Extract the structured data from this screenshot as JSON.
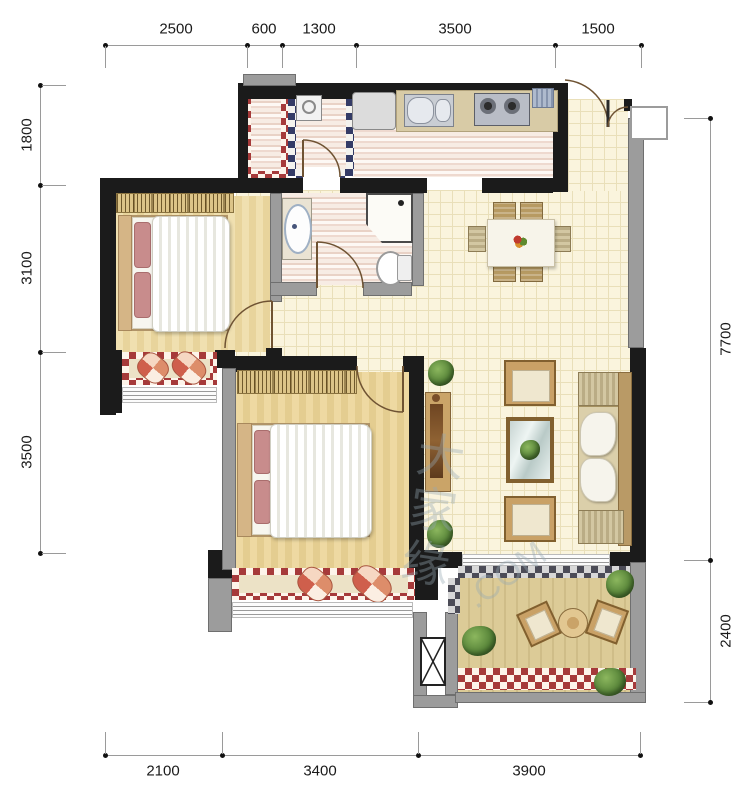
{
  "dimensions": {
    "top": [
      "2500",
      "600",
      "1300",
      "3500",
      "1500"
    ],
    "bottom": [
      "2100",
      "3400",
      "3900"
    ],
    "left": [
      "1800",
      "3100",
      "3500"
    ],
    "right": [
      "7700",
      "2400"
    ]
  },
  "watermark": {
    "cn": "大家缘",
    "com": ".COM"
  }
}
